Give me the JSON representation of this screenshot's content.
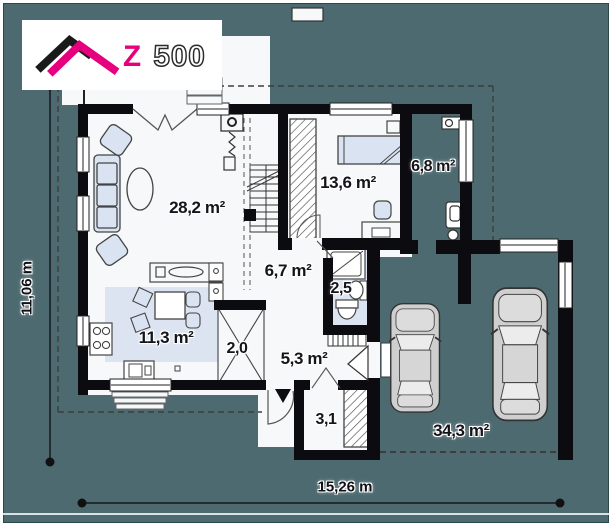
{
  "logo": {
    "z": "Z",
    "five_hundred": "500"
  },
  "rooms": [
    {
      "id": "living-room",
      "area_label": "28,2 m²"
    },
    {
      "id": "bedroom",
      "area_label": "13,6 m²"
    },
    {
      "id": "boiler-room",
      "area_label": "6,8 m²"
    },
    {
      "id": "hall",
      "area_label": "6,7 m²"
    },
    {
      "id": "wc",
      "area_label": "2,5"
    },
    {
      "id": "kitchen",
      "area_label": "11,3 m²"
    },
    {
      "id": "pantry",
      "area_label": "2,0"
    },
    {
      "id": "entry-hall",
      "area_label": "5,3 m²"
    },
    {
      "id": "wardrobe",
      "area_label": "3,1"
    },
    {
      "id": "garage",
      "area_label": "34,3 m²"
    }
  ],
  "dimensions": {
    "width_label": "15,26 m",
    "height_label": "11,06 m"
  },
  "colors": {
    "background_teal": "#4d6a70",
    "wall_black": "#0b0b10",
    "floor_white": "#f7f8fa",
    "furniture_blue": "#d9e3f1",
    "logo_magenta": "#e6007e"
  }
}
